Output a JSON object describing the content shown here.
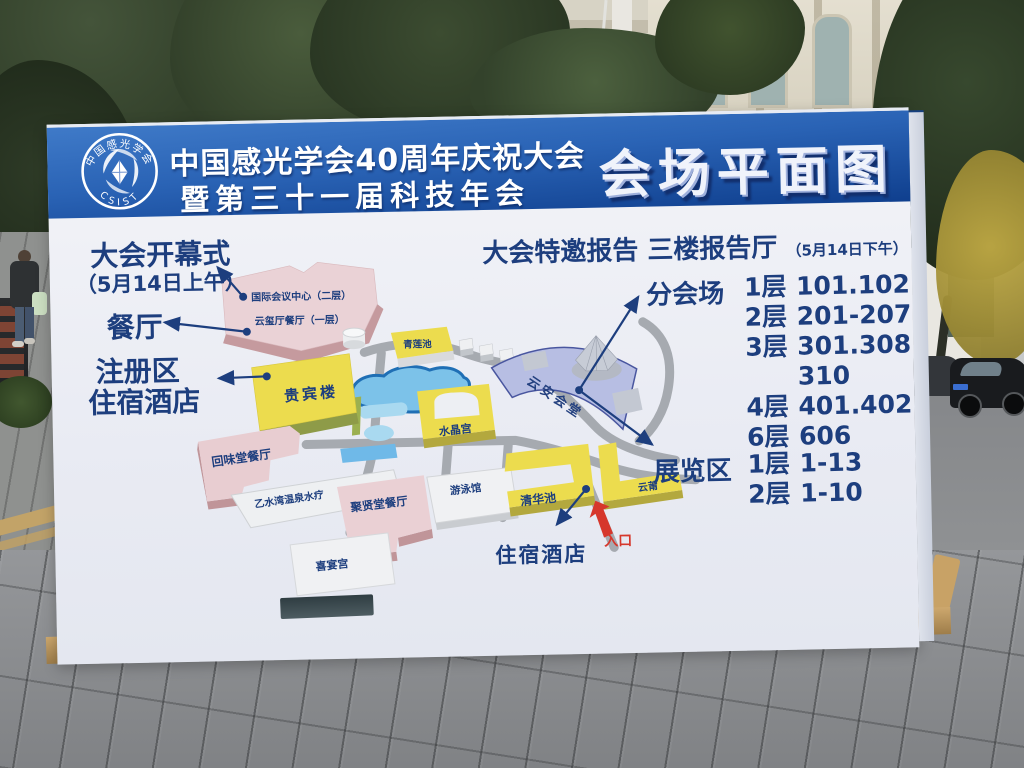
{
  "header": {
    "logo_top": "中国感光学会",
    "logo_bottom": "CSIST",
    "title_line1": "中国感光学会40周年庆祝大会",
    "title_line2": "暨第三十一届科技年会",
    "map_title": "会场平面图"
  },
  "callouts": {
    "opening": "大会开幕式",
    "opening_time": "（5月14日上午）",
    "dining": "餐厅",
    "registration_line1": "注册区",
    "registration_line2": "住宿酒店",
    "lodging": "住宿酒店",
    "entrance": "入口"
  },
  "report": {
    "title": "大会特邀报告 三楼报告厅",
    "time": "（5月14日下午）",
    "sessions_label": "分会场",
    "sessions": [
      {
        "floor": "1层",
        "rooms": "101.102"
      },
      {
        "floor": "2层",
        "rooms": "201-207"
      },
      {
        "floor": "3层",
        "rooms": "301.308"
      },
      {
        "floor": "",
        "rooms": "310"
      },
      {
        "floor": "4层",
        "rooms": "401.402"
      },
      {
        "floor": "6层",
        "rooms": "606"
      }
    ],
    "exhibition_label": "展览区",
    "exhibition": [
      {
        "floor": "1层",
        "rooms": "1-13"
      },
      {
        "floor": "2层",
        "rooms": "1-10"
      }
    ]
  },
  "buildings": {
    "intl_center": "国际会议中心（二层）",
    "yunxi_restaurant": "云玺厅餐厅（一层）",
    "vip_building": "贵宾楼",
    "qinglian_pool": "青莲池",
    "landscape_pool": "景观泳池",
    "crystal_palace": "水晶宫",
    "yunan_hall": "云安会堂",
    "huiwei_restaurant": "回味堂餐厅",
    "spa": "乙水湾温泉水疗",
    "juxian_restaurant": "聚贤堂餐厅",
    "natatorium": "游泳馆",
    "qinghua_pool": "清华池",
    "yunpu": "云莆",
    "xiyan_palace": "喜宴宫"
  },
  "colors": {
    "header_blue": "#1b4f9e",
    "navy_text": "#1d3e7e",
    "entrance_red": "#d6372c",
    "building_yellow": "#ecdc4e",
    "building_pink": "#ead2d6",
    "hall_periwinkle": "#b7bee3",
    "pool_blue": "#7cc2e9"
  }
}
